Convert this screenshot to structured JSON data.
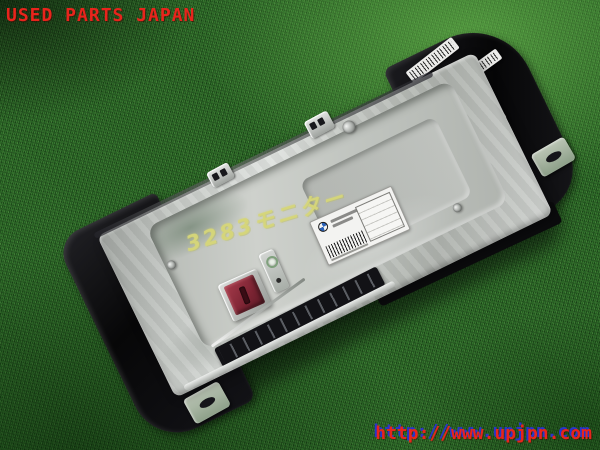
{
  "scene": {
    "description": "Used car in-dash display monitor unit with cast aluminum back, photographed on green artificial turf"
  },
  "watermarks": {
    "top_left": "USED PARTS JAPAN",
    "bottom_right_url": "http://www.upjpn.com",
    "text_color": "#e8241c",
    "url_shadow_color": "#2a35c8"
  },
  "unit": {
    "handwritten_marking": "3283モニター",
    "marking_color": "#d6d67a",
    "body_color": "#c6cac6",
    "bezel_color": "#0d0d10",
    "connector_color": "#8e2f3e",
    "label": {
      "logo_icon": "bmw-roundel",
      "logo_colors": [
        "#2a62b8",
        "#f2f2f2"
      ],
      "has_barcode": true
    }
  }
}
